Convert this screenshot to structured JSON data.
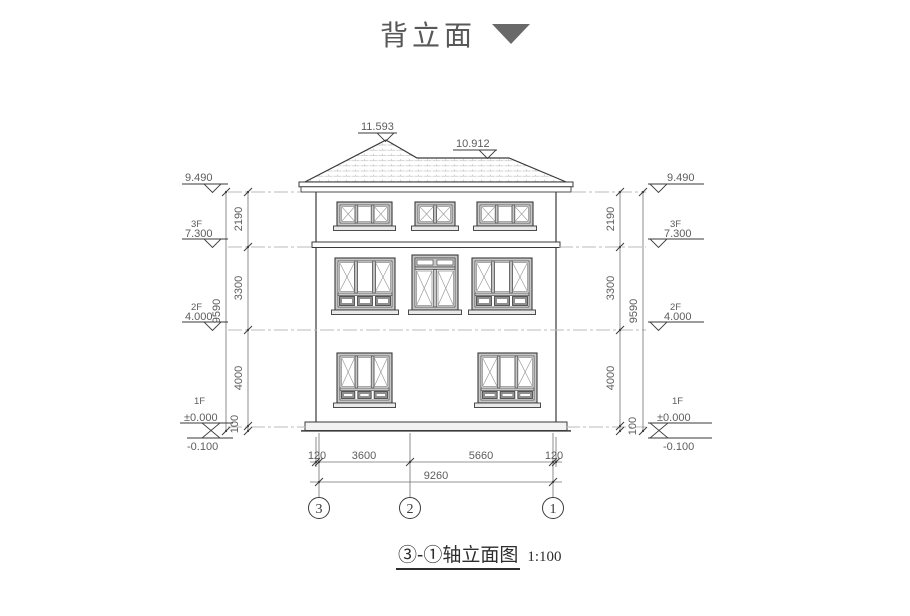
{
  "header": {
    "title": "背立面"
  },
  "caption": {
    "title": "③-①轴立面图",
    "scale": "1:100"
  },
  "roof": {
    "peak_elevation": "11.593",
    "ridge_elevation": "10.912"
  },
  "levels": {
    "eave": {
      "value": "9.490"
    },
    "f3": {
      "floor": "3F",
      "value": "7.300"
    },
    "f2": {
      "floor": "2F",
      "value": "4.000"
    },
    "f1": {
      "floor": "1F",
      "value": "±0.000"
    },
    "ground": {
      "value": "-0.100"
    }
  },
  "vdims": {
    "segments": [
      "2190",
      "3300",
      "4000",
      "100"
    ],
    "total": "9590"
  },
  "hdims": {
    "segments": [
      "120",
      "3600",
      "5660",
      "120"
    ],
    "total": "9260"
  },
  "axes": [
    "3",
    "2",
    "1"
  ],
  "colors": {
    "line": "#3a3a3a",
    "dim_line": "#707070",
    "dash_line": "#bbbbbb",
    "tile": "#c2c2c2",
    "frame_fill": "#c7c7c7",
    "pane_dark": "#8f8f8f",
    "title_text": "#585858",
    "triangle": "#696969",
    "dim_text": "#5d5d5d"
  }
}
